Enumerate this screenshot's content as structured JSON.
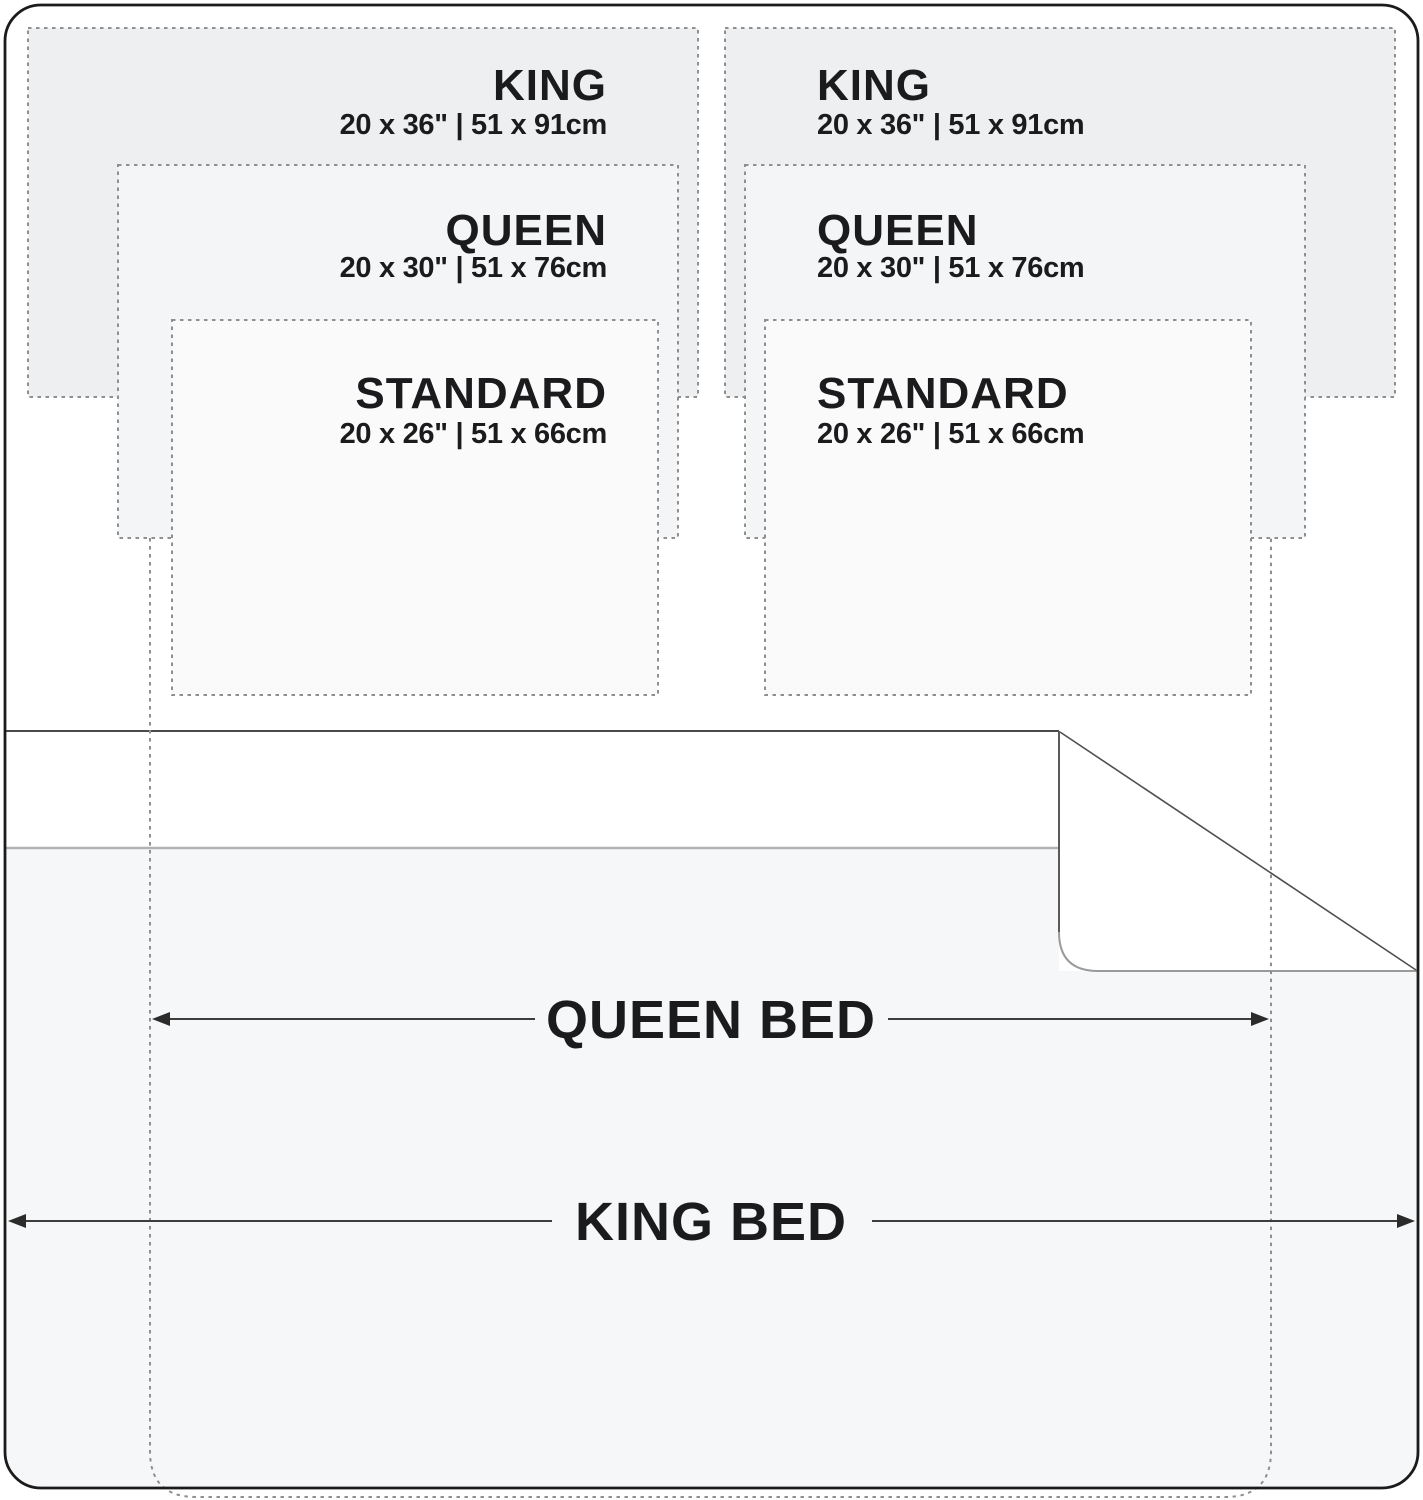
{
  "pillows": {
    "king": {
      "label": "KING",
      "dims": "20 x 36\" | 51 x 91cm"
    },
    "queen": {
      "label": "QUEEN",
      "dims": "20 x 30\" | 51 x 76cm"
    },
    "standard": {
      "label": "STANDARD",
      "dims": "20 x 26\" | 51 x 66cm"
    }
  },
  "beds": {
    "queen": {
      "label": "QUEEN BED"
    },
    "king": {
      "label": "KING BED"
    }
  },
  "colors": {
    "pillow_king_fill": "#eeeff1",
    "pillow_queen_fill": "#f4f5f6",
    "pillow_standard_fill": "#fafafb",
    "bed_fill": "#f6f7f8",
    "sheet_fill": "#ffffff",
    "dashed_line": "#8f8f8f",
    "text": "#1b1b1d",
    "border": "#1b1b1b",
    "arrow": "#3d3d3d"
  }
}
